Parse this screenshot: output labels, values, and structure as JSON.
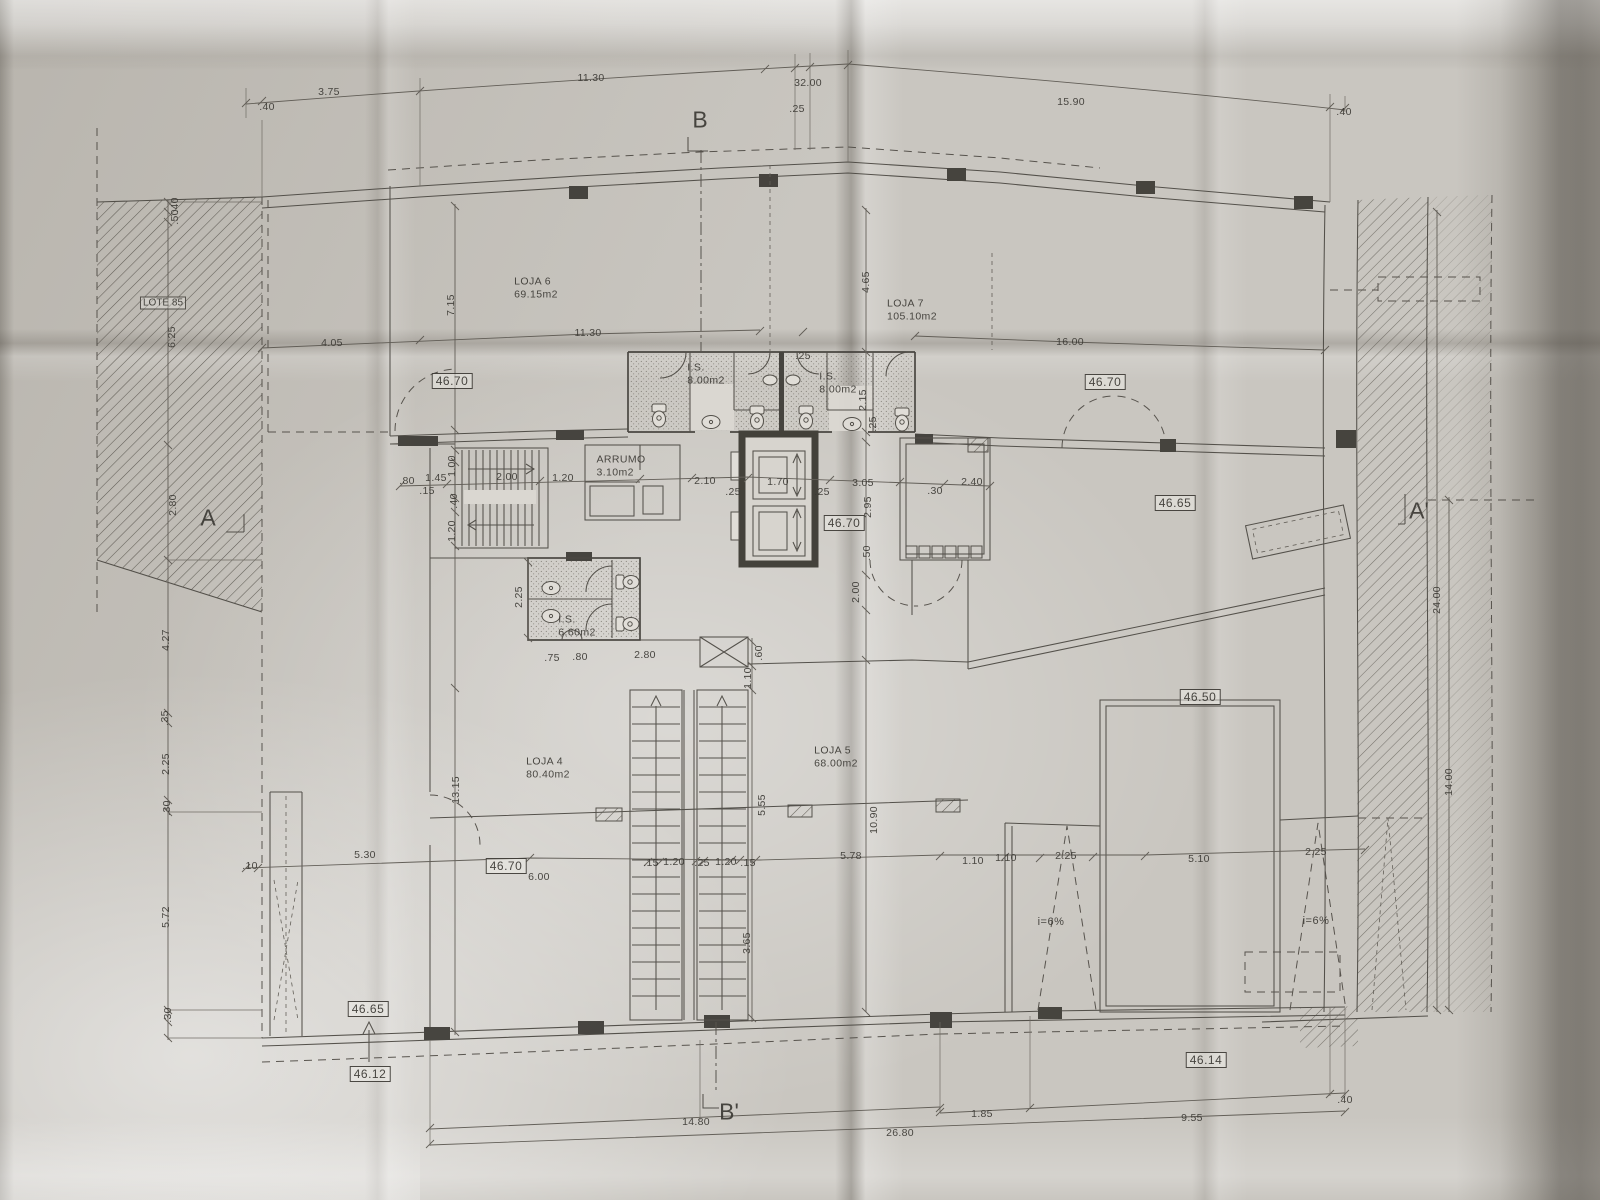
{
  "drawing": {
    "type": "architectural ground-floor plan, photographed on folded paper"
  },
  "section_markers": [
    {
      "label": "B",
      "x": 700,
      "y": 120
    },
    {
      "label": "B'",
      "x": 729,
      "y": 1112
    },
    {
      "label": "A",
      "x": 208,
      "y": 518
    },
    {
      "label": "A'",
      "x": 1419,
      "y": 511
    }
  ],
  "rooms": [
    {
      "name": "LOJA 6",
      "area": "69.15m2",
      "x": 536,
      "y": 288
    },
    {
      "name": "LOJA 7",
      "area": "105.10m2",
      "x": 912,
      "y": 310
    },
    {
      "name": "LOJA 4",
      "area": "80.40m2",
      "x": 548,
      "y": 768
    },
    {
      "name": "LOJA 5",
      "area": "68.00m2",
      "x": 836,
      "y": 757
    },
    {
      "name": "I.S.",
      "area": "8.00m2",
      "x": 706,
      "y": 374
    },
    {
      "name": "I.S.",
      "area": "8.00m2",
      "x": 838,
      "y": 383
    },
    {
      "name": "I.S.",
      "area": "6.60m2",
      "x": 577,
      "y": 626
    },
    {
      "name": "ARRUMO",
      "area": "3.10m2",
      "x": 621,
      "y": 466
    }
  ],
  "site_labels": [
    {
      "text": "LOTE 85",
      "x": 163,
      "y": 303
    }
  ],
  "levels": [
    {
      "text": "46.70",
      "x": 452,
      "y": 381
    },
    {
      "text": "46.70",
      "x": 1105,
      "y": 382
    },
    {
      "text": "46.70",
      "x": 844,
      "y": 523
    },
    {
      "text": "46.65",
      "x": 1175,
      "y": 503
    },
    {
      "text": "46.50",
      "x": 1200,
      "y": 697
    },
    {
      "text": "46.70",
      "x": 506,
      "y": 866
    },
    {
      "text": "46.65",
      "x": 368,
      "y": 1009
    },
    {
      "text": "46.12",
      "x": 370,
      "y": 1074
    },
    {
      "text": "46.14",
      "x": 1206,
      "y": 1060
    }
  ],
  "ramp_labels": [
    {
      "text": "i=6%",
      "x": 1051,
      "y": 922
    },
    {
      "text": "i=6%",
      "x": 1316,
      "y": 921
    }
  ],
  "dimensions": [
    {
      "text": ".40",
      "x": 267,
      "y": 107
    },
    {
      "text": "3.75",
      "x": 329,
      "y": 92
    },
    {
      "text": "11.30",
      "x": 591,
      "y": 78
    },
    {
      "text": "32.00",
      "x": 808,
      "y": 83
    },
    {
      "text": ".25",
      "x": 797,
      "y": 109
    },
    {
      "text": "15.90",
      "x": 1071,
      "y": 102
    },
    {
      "text": ".40",
      "x": 1344,
      "y": 112
    },
    {
      "text": "4.05",
      "x": 332,
      "y": 343
    },
    {
      "text": "11.30",
      "x": 588,
      "y": 333
    },
    {
      "text": "16.00",
      "x": 1070,
      "y": 342
    },
    {
      "text": ".25",
      "x": 803,
      "y": 356
    },
    {
      "text": ".40",
      "x": 175,
      "y": 205,
      "rot": -90
    },
    {
      "text": ".50",
      "x": 175,
      "y": 217,
      "rot": -90
    },
    {
      "text": "6.25",
      "x": 172,
      "y": 337,
      "rot": -90
    },
    {
      "text": "2.80",
      "x": 173,
      "y": 505,
      "rot": -90
    },
    {
      "text": "4.27",
      "x": 166,
      "y": 640,
      "rot": -90
    },
    {
      "text": ".35",
      "x": 165,
      "y": 718,
      "rot": -90
    },
    {
      "text": "2.25",
      "x": 166,
      "y": 764,
      "rot": -90
    },
    {
      "text": ".30",
      "x": 167,
      "y": 808,
      "rot": -90
    },
    {
      "text": "5.72",
      "x": 166,
      "y": 917,
      "rot": -90
    },
    {
      "text": ".30",
      "x": 168,
      "y": 1015,
      "rot": -90
    },
    {
      "text": "7.15",
      "x": 451,
      "y": 305,
      "rot": -90
    },
    {
      "text": "1.00",
      "x": 452,
      "y": 466,
      "rot": -90
    },
    {
      "text": ".40",
      "x": 454,
      "y": 501,
      "rot": -90
    },
    {
      "text": "1.20",
      "x": 452,
      "y": 531,
      "rot": -90
    },
    {
      "text": "13.15",
      "x": 456,
      "y": 790,
      "rot": -90
    },
    {
      "text": ".80",
      "x": 407,
      "y": 481
    },
    {
      "text": "1.45",
      "x": 436,
      "y": 478
    },
    {
      "text": ".15",
      "x": 427,
      "y": 491
    },
    {
      "text": "2.00",
      "x": 507,
      "y": 477
    },
    {
      "text": "1.20",
      "x": 563,
      "y": 478
    },
    {
      "text": "2.10",
      "x": 705,
      "y": 481
    },
    {
      "text": ".25",
      "x": 733,
      "y": 492
    },
    {
      "text": "1.70",
      "x": 778,
      "y": 482
    },
    {
      "text": ".25",
      "x": 822,
      "y": 492
    },
    {
      "text": "3.05",
      "x": 863,
      "y": 483
    },
    {
      "text": ".30",
      "x": 935,
      "y": 491
    },
    {
      "text": "2.40",
      "x": 972,
      "y": 482
    },
    {
      "text": "4.65",
      "x": 866,
      "y": 282,
      "rot": -90
    },
    {
      "text": "2.15",
      "x": 863,
      "y": 400,
      "rot": -90
    },
    {
      "text": ".25",
      "x": 873,
      "y": 424,
      "rot": -90
    },
    {
      "text": "2.95",
      "x": 868,
      "y": 507,
      "rot": -90
    },
    {
      "text": ".50",
      "x": 867,
      "y": 553,
      "rot": -90
    },
    {
      "text": "2.00",
      "x": 856,
      "y": 592,
      "rot": -90
    },
    {
      "text": "10.90",
      "x": 874,
      "y": 820,
      "rot": -90
    },
    {
      "text": "2.25",
      "x": 519,
      "y": 597,
      "rot": -90
    },
    {
      "text": ".75",
      "x": 552,
      "y": 658
    },
    {
      "text": ".80",
      "x": 580,
      "y": 657
    },
    {
      "text": "2.80",
      "x": 645,
      "y": 655
    },
    {
      "text": ".60",
      "x": 759,
      "y": 653,
      "rot": -90
    },
    {
      "text": "1.10",
      "x": 748,
      "y": 678,
      "rot": -90
    },
    {
      "text": "5.55",
      "x": 762,
      "y": 805,
      "rot": -90
    },
    {
      "text": "3.65",
      "x": 747,
      "y": 943,
      "rot": -90
    },
    {
      "text": ".10",
      "x": 250,
      "y": 866
    },
    {
      "text": "5.30",
      "x": 365,
      "y": 855
    },
    {
      "text": "6.00",
      "x": 539,
      "y": 877
    },
    {
      "text": ".15",
      "x": 651,
      "y": 863
    },
    {
      "text": "1.20",
      "x": 674,
      "y": 862
    },
    {
      "text": ".25",
      "x": 702,
      "y": 863
    },
    {
      "text": "1.20",
      "x": 726,
      "y": 862
    },
    {
      "text": ".15",
      "x": 748,
      "y": 863
    },
    {
      "text": "5.78",
      "x": 851,
      "y": 856
    },
    {
      "text": "1.10",
      "x": 973,
      "y": 861
    },
    {
      "text": "1.10",
      "x": 1006,
      "y": 858
    },
    {
      "text": "2.25",
      "x": 1066,
      "y": 856
    },
    {
      "text": "5.10",
      "x": 1199,
      "y": 859
    },
    {
      "text": "2.25",
      "x": 1316,
      "y": 852
    },
    {
      "text": "24.00",
      "x": 1437,
      "y": 600,
      "rot": -90
    },
    {
      "text": "14.00",
      "x": 1449,
      "y": 782,
      "rot": -90
    },
    {
      "text": "1.85",
      "x": 982,
      "y": 1114
    },
    {
      "text": "9.55",
      "x": 1192,
      "y": 1118
    },
    {
      "text": ".40",
      "x": 1345,
      "y": 1100
    },
    {
      "text": "14.80",
      "x": 696,
      "y": 1122
    },
    {
      "text": "26.80",
      "x": 900,
      "y": 1133
    }
  ]
}
